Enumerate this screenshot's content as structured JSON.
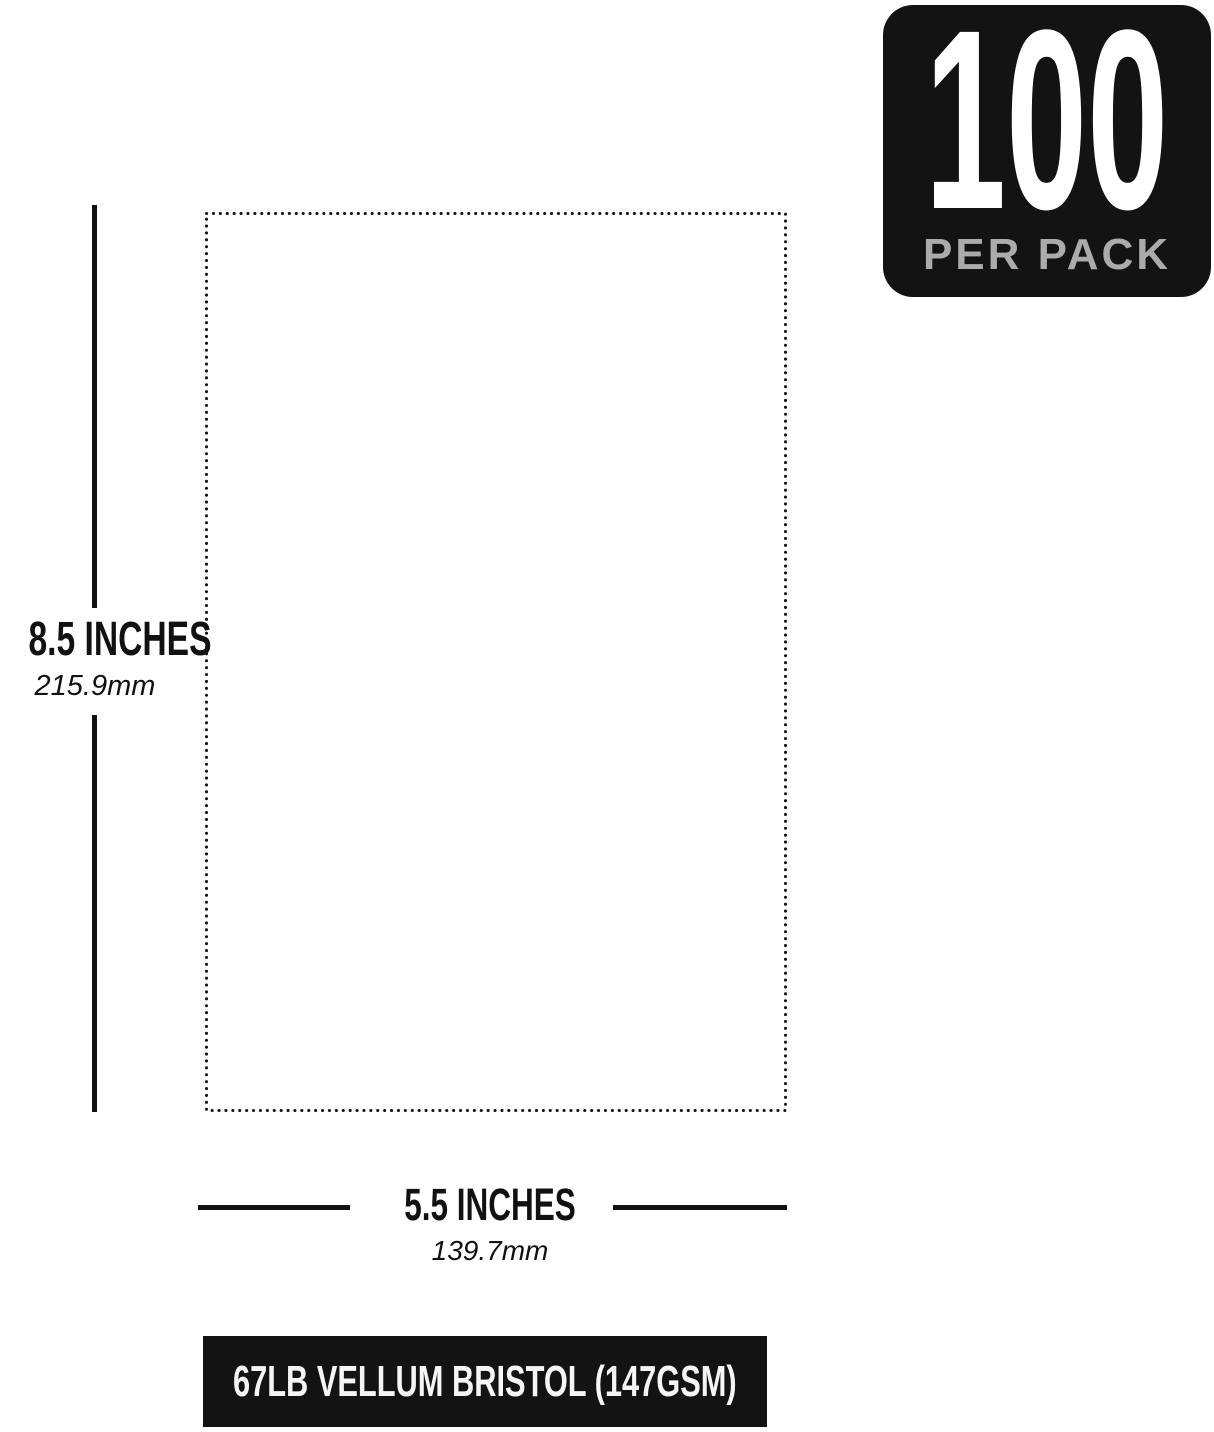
{
  "badge": {
    "count": "100",
    "unit_label": "PER PACK"
  },
  "height_measure": {
    "inches": "8.5 INCHES",
    "mm": "215.9mm"
  },
  "width_measure": {
    "inches": "5.5 INCHES",
    "mm": "139.7mm"
  },
  "banner": {
    "label": "67LB VELLUM BRISTOL (147GSM)"
  },
  "colors": {
    "ink": "#111111",
    "badge_background": "#131313",
    "badge_sub_text": "#ababab",
    "banner_background": "#131313",
    "banner_text": "#f5f5f5",
    "page_background": "#ffffff"
  }
}
